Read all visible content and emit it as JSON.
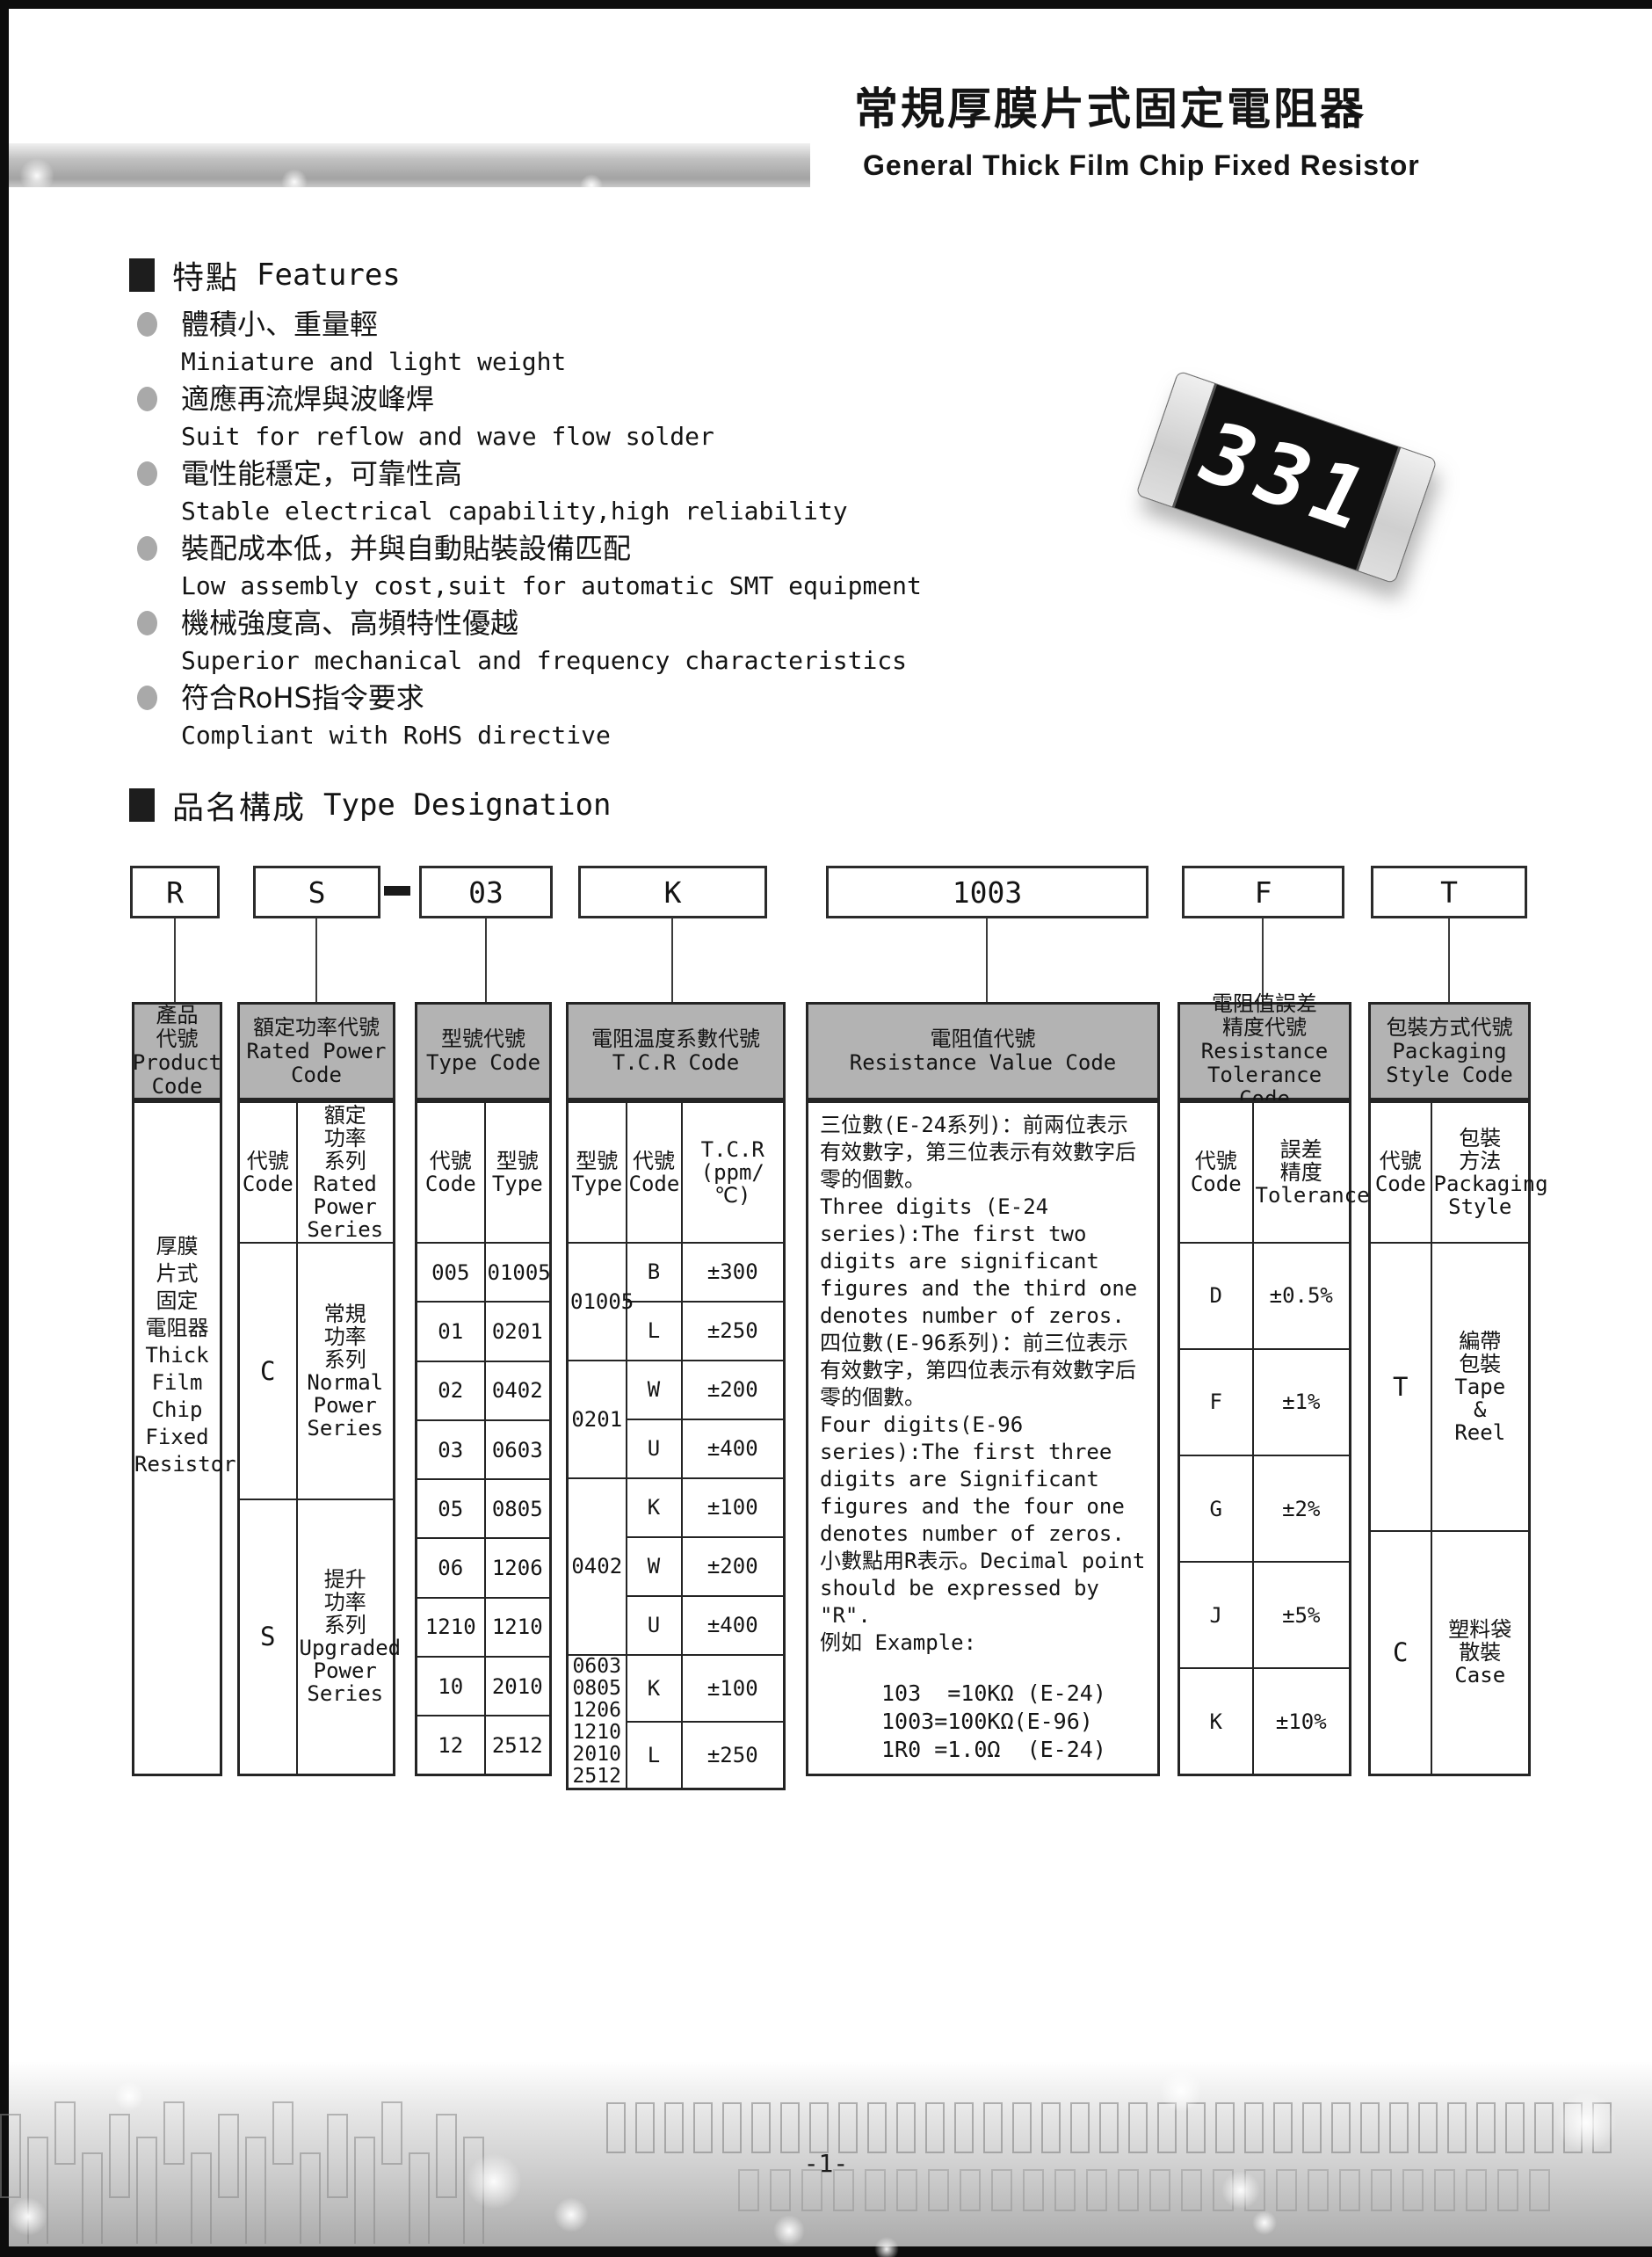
{
  "colors": {
    "header_fill": "#b3b3b3",
    "table_border": "#242424",
    "page_edge": "#0d0d0d"
  },
  "header": {
    "title_zh": "常規厚膜片式固定電阻器",
    "title_en": "General Thick Film Chip Fixed Resistor"
  },
  "features": {
    "heading_zh": "特點",
    "heading_en": "Features",
    "items": [
      {
        "zh": "體積小、重量輕",
        "en": "Miniature and light weight"
      },
      {
        "zh": "適應再流焊與波峰焊",
        "en": "Suit for reflow and wave flow solder"
      },
      {
        "zh": "電性能穩定，可靠性高",
        "en": "Stable electrical capability,high reliability"
      },
      {
        "zh": "裝配成本低，并與自動貼裝設備匹配",
        "en": "Low assembly cost,suit for automatic SMT equipment"
      },
      {
        "zh": "機械強度高、高頻特性優越",
        "en": "Superior mechanical and frequency characteristics"
      },
      {
        "zh": "符合RoHS指令要求",
        "en": "Compliant with RoHS directive"
      }
    ]
  },
  "resistor": {
    "marking": "331"
  },
  "designation": {
    "heading_zh": "品名構成",
    "heading_en": "Type Designation",
    "boxes": {
      "product": "R",
      "power": "S",
      "type": "03",
      "tcr": "K",
      "value": "1003",
      "tolerance": "F",
      "packaging": "T"
    }
  },
  "table": {
    "col_product": {
      "header": "產品\n代號\nProduct\nCode",
      "body": "厚膜\n片式\n固定\n電阻器\nThick\nFilm\nChip\nFixed\nResistor"
    },
    "col_power": {
      "header": "額定功率代號\nRated Power\nCode",
      "sub_code": "代號\nCode",
      "sub_series": "額定\n功率\n系列\nRated\nPower\nSeries",
      "rows": [
        {
          "code": "C",
          "series": "常規\n功率\n系列\nNormal\nPower\nSeries"
        },
        {
          "code": "S",
          "series": "提升\n功率\n系列\nUpgraded\nPower\nSeries"
        }
      ]
    },
    "col_type": {
      "header": "型號代號\nType Code",
      "sub_code": "代號\nCode",
      "sub_type": "型號\nType",
      "rows": [
        [
          "005",
          "01005"
        ],
        [
          "01",
          "0201"
        ],
        [
          "02",
          "0402"
        ],
        [
          "03",
          "0603"
        ],
        [
          "05",
          "0805"
        ],
        [
          "06",
          "1206"
        ],
        [
          "1210",
          "1210"
        ],
        [
          "10",
          "2010"
        ],
        [
          "12",
          "2512"
        ]
      ]
    },
    "col_tcr": {
      "header": "電阻温度系數代號\nT.C.R Code",
      "sub_type": "型號\nType",
      "sub_code": "代號\nCode",
      "sub_tcr": "T.C.R\n(ppm/℃)",
      "groups": [
        {
          "type": "01005",
          "entries": [
            [
              "B",
              "±300"
            ],
            [
              "L",
              "±250"
            ]
          ]
        },
        {
          "type": "0201",
          "entries": [
            [
              "W",
              "±200"
            ],
            [
              "U",
              "±400"
            ]
          ]
        },
        {
          "type": "0402",
          "entries": [
            [
              "K",
              "±100"
            ],
            [
              "W",
              "±200"
            ],
            [
              "U",
              "±400"
            ]
          ]
        },
        {
          "type": "0603\n0805\n1206\n1210\n2010\n2512",
          "entries": [
            [
              "K",
              "±100"
            ],
            [
              "L",
              "±250"
            ]
          ]
        }
      ]
    },
    "col_value": {
      "header": "電阻值代號\nResistance Value Code",
      "paragraphs": [
        "三位數(E-24系列)：前兩位表示有效數字，第三位表示有效數字后零的個數。",
        "Three digits (E-24 series):The first two digits are significant figures and the third one denotes number of zeros.",
        "四位數(E-96系列)：前三位表示有效數字，第四位表示有效數字后零的個數。",
        "Four digits(E-96 series):The first three digits are Significant figures and the four one denotes number of zeros.",
        "小數點用R表示。Decimal point should be expressed by \"R\".",
        "例如 Example:"
      ],
      "examples": "103  =10KΩ (E-24)\n1003=100KΩ(E-96)\n1R0 =1.0Ω  (E-24)"
    },
    "col_tolerance": {
      "header": "電阻值誤差\n精度代號\nResistance\nTolerance Code",
      "sub_code": "代號\nCode",
      "sub_tol": "誤差\n精度\nTolerance",
      "rows": [
        [
          "D",
          "±0.5%"
        ],
        [
          "F",
          "±1%"
        ],
        [
          "G",
          "±2%"
        ],
        [
          "J",
          "±5%"
        ],
        [
          "K",
          "±10%"
        ]
      ]
    },
    "col_packaging": {
      "header": "包裝方式代號\nPackaging\nStyle Code",
      "sub_code": "代號\nCode",
      "sub_style": "包裝\n方法\nPackaging\nStyle",
      "rows": [
        {
          "code": "T",
          "style": "編帶\n包裝\nTape\n&\nReel"
        },
        {
          "code": "C",
          "style": "塑料袋\n散裝\nCase"
        }
      ]
    }
  },
  "footer": {
    "page_number": "-1-"
  }
}
